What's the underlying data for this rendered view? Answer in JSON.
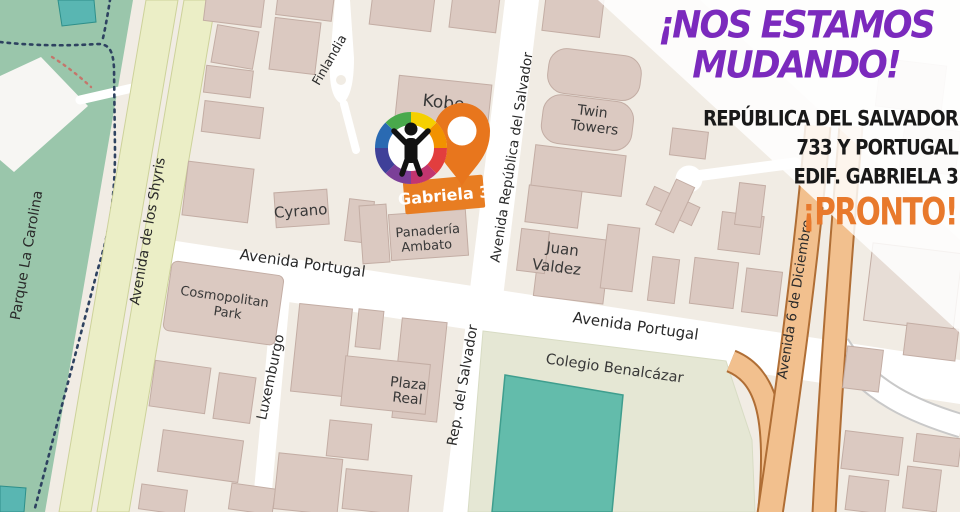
{
  "promo": {
    "headline": [
      "¡NOS ESTAMOS",
      "MUDANDO!"
    ],
    "address": [
      "REPÚBLICA DEL SALVADOR",
      "733 Y PORTUGAL",
      "EDIF. GABRIELA 3"
    ],
    "coming_soon": "¡PRONTO!"
  },
  "annotation": {
    "destination_label": "Gabriela 3"
  },
  "map": {
    "park_label": "Parque La Carolina",
    "streets": {
      "shyris": "Avenida de los Shyris",
      "portugal_west": "Avenida Portugal",
      "portugal_east": "Avenida Portugal",
      "republica_north": "Avenida República del Salvador",
      "republica_south": "Rep. del Salvador",
      "finlandia": "Finlandia",
      "luxemburgo": "Luxemburgo",
      "seis_diciembre": "Avenida 6 de Diciembre"
    },
    "places": {
      "kobe": "Kobe",
      "twin_towers_line1": "Twin",
      "twin_towers_line2": "Towers",
      "cyrano": "Cyrano",
      "panaderia_line1": "Panadería",
      "panaderia_line2": "Ambato",
      "juan_valdez_line1": "Juan",
      "juan_valdez_line2": "Valdez",
      "cosmopolitan_line1": "Cosmopolitan",
      "cosmopolitan_line2": "Park",
      "plaza_real_line1": "Plaza",
      "plaza_real_line2": "Real",
      "colegio": "Colegio Benalcázar"
    }
  },
  "icons": {
    "logo": "rainbow-ring-person-logo",
    "pin": "location-pin"
  },
  "colors": {
    "headline_purple": "#7b2abd",
    "coming_soon_orange": "#e8792c",
    "address_black": "#191919",
    "accent_orange": "#e87d22",
    "pin_orange": "#e8761d",
    "park_green": "#9ac6ab",
    "sports_field_teal": "#63bcab",
    "avenue_yellow": "#ebeec6",
    "avenue_orange": "#f2c08e",
    "building_fill": "#dbc9c1"
  }
}
